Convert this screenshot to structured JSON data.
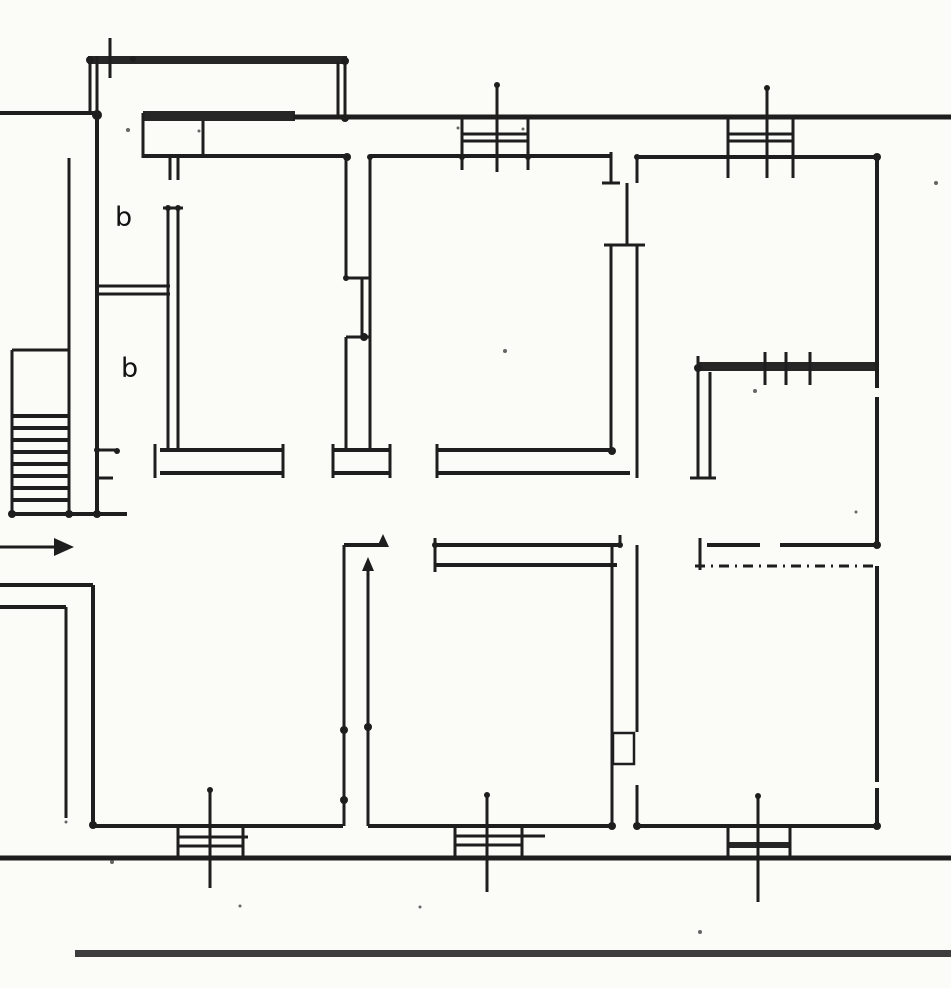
{
  "meta": {
    "description": "scanned floor plan drawing",
    "paper_color": "#fbfbf8",
    "ink_color": "#1e1e1e",
    "band_color": "#262626",
    "street_band_color": "#3d3d3d",
    "width": 951,
    "height": 988
  },
  "labels": [
    {
      "text": "b",
      "x": 115,
      "y": 204,
      "size": 27
    },
    {
      "text": "b",
      "x": 121,
      "y": 355,
      "size": 27
    }
  ],
  "plan": {
    "fill_bands": [
      {
        "name": "balcony-rail",
        "x": 88,
        "y": 56,
        "w": 259,
        "h": 8
      },
      {
        "name": "top-wall-band",
        "x": 143,
        "y": 111,
        "w": 152,
        "h": 10
      },
      {
        "name": "thick-interior-wall",
        "x": 698,
        "y": 362,
        "w": 180,
        "h": 9
      },
      {
        "name": "window-band-bottom-right",
        "x": 728,
        "y": 842,
        "w": 62,
        "h": 6
      },
      {
        "name": "street-band",
        "x": 75,
        "y": 950,
        "w": 876,
        "h": 7
      }
    ],
    "hlines": [
      [
        0,
        100,
        113,
        4
      ],
      [
        293,
        951,
        117,
        5
      ],
      [
        143,
        347,
        156,
        4
      ],
      [
        370,
        611,
        156,
        4
      ],
      [
        637,
        877,
        157,
        4
      ],
      [
        462,
        528,
        134,
        3
      ],
      [
        462,
        528,
        141,
        3
      ],
      [
        728,
        793,
        134,
        3
      ],
      [
        728,
        793,
        141,
        3
      ],
      [
        97,
        170,
        286,
        3
      ],
      [
        97,
        170,
        294,
        3
      ],
      [
        346,
        370,
        278,
        3
      ],
      [
        346,
        370,
        337,
        3
      ],
      [
        12,
        69,
        350,
        3
      ],
      [
        97,
        117,
        450,
        3
      ],
      [
        97,
        113,
        478,
        3
      ],
      [
        160,
        283,
        450,
        4
      ],
      [
        160,
        283,
        473,
        4
      ],
      [
        333,
        390,
        450,
        4
      ],
      [
        333,
        390,
        473,
        4
      ],
      [
        437,
        612,
        450,
        4
      ],
      [
        437,
        630,
        473,
        4
      ],
      [
        690,
        716,
        478,
        3
      ],
      [
        435,
        620,
        545,
        4
      ],
      [
        435,
        617,
        565,
        4
      ],
      [
        707,
        760,
        545,
        4
      ],
      [
        780,
        877,
        545,
        4
      ],
      [
        344,
        385,
        545,
        4
      ],
      [
        12,
        127,
        514,
        4
      ],
      [
        0,
        93,
        585,
        4
      ],
      [
        0,
        66,
        607,
        4
      ],
      [
        93,
        343,
        826,
        4
      ],
      [
        368,
        612,
        826,
        4
      ],
      [
        637,
        877,
        826,
        4
      ],
      [
        0,
        951,
        858,
        5
      ],
      [
        178,
        248,
        837,
        3
      ],
      [
        178,
        243,
        846,
        3
      ],
      [
        455,
        545,
        836,
        3
      ],
      [
        455,
        522,
        845,
        3
      ],
      [
        602,
        620,
        183,
        3
      ],
      [
        604,
        645,
        245,
        3
      ],
      [
        163,
        183,
        208,
        3
      ]
    ],
    "vlines": [
      [
        56,
        115,
        90,
        3
      ],
      [
        56,
        115,
        97,
        3
      ],
      [
        115,
        514,
        97,
        4
      ],
      [
        38,
        78,
        110,
        3
      ],
      [
        62,
        118,
        338,
        3
      ],
      [
        62,
        118,
        345,
        3
      ],
      [
        113,
        158,
        143,
        3
      ],
      [
        121,
        157,
        203,
        3
      ],
      [
        157,
        180,
        170,
        3
      ],
      [
        157,
        180,
        178,
        3
      ],
      [
        208,
        450,
        168,
        3
      ],
      [
        208,
        450,
        178,
        3
      ],
      [
        158,
        514,
        69,
        3
      ],
      [
        350,
        514,
        12,
        3
      ],
      [
        158,
        278,
        346,
        3
      ],
      [
        278,
        337,
        362,
        3
      ],
      [
        337,
        450,
        346,
        3
      ],
      [
        156,
        450,
        370,
        3
      ],
      [
        444,
        478,
        155,
        3
      ],
      [
        444,
        478,
        283,
        3
      ],
      [
        444,
        478,
        333,
        3
      ],
      [
        444,
        478,
        390,
        3
      ],
      [
        444,
        478,
        437,
        3
      ],
      [
        152,
        183,
        611,
        3
      ],
      [
        183,
        245,
        627,
        3
      ],
      [
        157,
        183,
        637,
        3
      ],
      [
        245,
        450,
        611,
        3
      ],
      [
        245,
        478,
        637,
        3
      ],
      [
        372,
        478,
        698,
        3
      ],
      [
        372,
        478,
        710,
        3
      ],
      [
        356,
        384,
        698,
        3
      ],
      [
        157,
        388,
        877,
        4
      ],
      [
        397,
        547,
        877,
        4
      ],
      [
        566,
        782,
        877,
        4
      ],
      [
        788,
        826,
        877,
        4
      ],
      [
        352,
        385,
        765,
        3
      ],
      [
        352,
        385,
        786,
        3
      ],
      [
        352,
        385,
        810,
        3
      ],
      [
        117,
        170,
        462,
        3
      ],
      [
        117,
        170,
        528,
        3
      ],
      [
        85,
        172,
        497,
        3
      ],
      [
        118,
        178,
        728,
        3
      ],
      [
        118,
        178,
        793,
        3
      ],
      [
        88,
        178,
        767,
        3
      ],
      [
        585,
        825,
        93,
        4
      ],
      [
        607,
        818,
        66,
        3
      ],
      [
        545,
        826,
        344,
        3
      ],
      [
        563,
        826,
        368,
        3
      ],
      [
        545,
        826,
        612,
        3
      ],
      [
        545,
        732,
        637,
        3
      ],
      [
        785,
        826,
        637,
        3
      ],
      [
        538,
        572,
        435,
        3
      ],
      [
        535,
        545,
        620,
        3
      ],
      [
        538,
        570,
        700,
        3
      ],
      [
        825,
        858,
        178,
        3
      ],
      [
        825,
        858,
        243,
        3
      ],
      [
        790,
        888,
        210,
        3
      ],
      [
        827,
        858,
        455,
        3
      ],
      [
        827,
        858,
        522,
        3
      ],
      [
        795,
        892,
        487,
        3
      ],
      [
        826,
        858,
        728,
        3
      ],
      [
        826,
        858,
        790,
        3
      ],
      [
        796,
        902,
        758,
        3
      ]
    ],
    "dashed_hlines": [
      [
        695,
        877,
        566,
        3
      ]
    ],
    "outline_rects": [
      {
        "name": "door-leaf-box",
        "x": 613,
        "y": 733,
        "w": 21,
        "h": 31
      }
    ],
    "stairs": {
      "x1": 12,
      "x2": 69,
      "t": 4,
      "tread_ys": [
        416,
        428,
        440,
        452,
        464,
        476,
        488,
        500
      ]
    },
    "arrows": [
      {
        "name": "entrance-arrow",
        "line": [
          0,
          547,
          56,
          547,
          3
        ],
        "head": "74,547 54,538 54,556"
      },
      {
        "name": "door-swing-arrow-1",
        "line": [
          368,
          570,
          368,
          596,
          2
        ],
        "head": "368,557 362,571 374,571"
      },
      {
        "name": "door-swing-arrow-2",
        "line": [
          383,
          545,
          383,
          545,
          2
        ],
        "head": "383,534 377,547 389,547"
      }
    ],
    "dots": [
      [
        90,
        60,
        4
      ],
      [
        133,
        59,
        3
      ],
      [
        345,
        61,
        4
      ],
      [
        97,
        115,
        5
      ],
      [
        345,
        118,
        4
      ],
      [
        347,
        157,
        4
      ],
      [
        370,
        157,
        3
      ],
      [
        346,
        278,
        3
      ],
      [
        364,
        337,
        4
      ],
      [
        97,
        450,
        3
      ],
      [
        117,
        451,
        3
      ],
      [
        97,
        514,
        4
      ],
      [
        69,
        514,
        4
      ],
      [
        12,
        514,
        4
      ],
      [
        168,
        208,
        3
      ],
      [
        178,
        208,
        3
      ],
      [
        612,
        451,
        4
      ],
      [
        637,
        157,
        3
      ],
      [
        877,
        157,
        4
      ],
      [
        877,
        545,
        4
      ],
      [
        435,
        545,
        3
      ],
      [
        620,
        545,
        3
      ],
      [
        344,
        730,
        4
      ],
      [
        368,
        727,
        4
      ],
      [
        344,
        800,
        4
      ],
      [
        612,
        826,
        4
      ],
      [
        637,
        826,
        4
      ],
      [
        93,
        825,
        4
      ],
      [
        877,
        826,
        4
      ],
      [
        698,
        368,
        4
      ],
      [
        528,
        157,
        3
      ],
      [
        462,
        157,
        3
      ],
      [
        487,
        795,
        3
      ],
      [
        210,
        790,
        3
      ],
      [
        758,
        796,
        3
      ],
      [
        497,
        85,
        3
      ],
      [
        767,
        88,
        3
      ]
    ],
    "specks": [
      [
        128,
        130,
        2
      ],
      [
        199,
        131,
        1.5
      ],
      [
        458,
        128,
        1.5
      ],
      [
        523,
        129,
        1.5
      ],
      [
        505,
        351,
        2
      ],
      [
        755,
        391,
        2
      ],
      [
        936,
        183,
        2
      ],
      [
        112,
        862,
        2
      ],
      [
        240,
        906,
        1.5
      ],
      [
        420,
        907,
        1.5
      ],
      [
        700,
        932,
        2
      ],
      [
        66,
        822,
        1.5
      ],
      [
        856,
        512,
        1.5
      ]
    ]
  }
}
